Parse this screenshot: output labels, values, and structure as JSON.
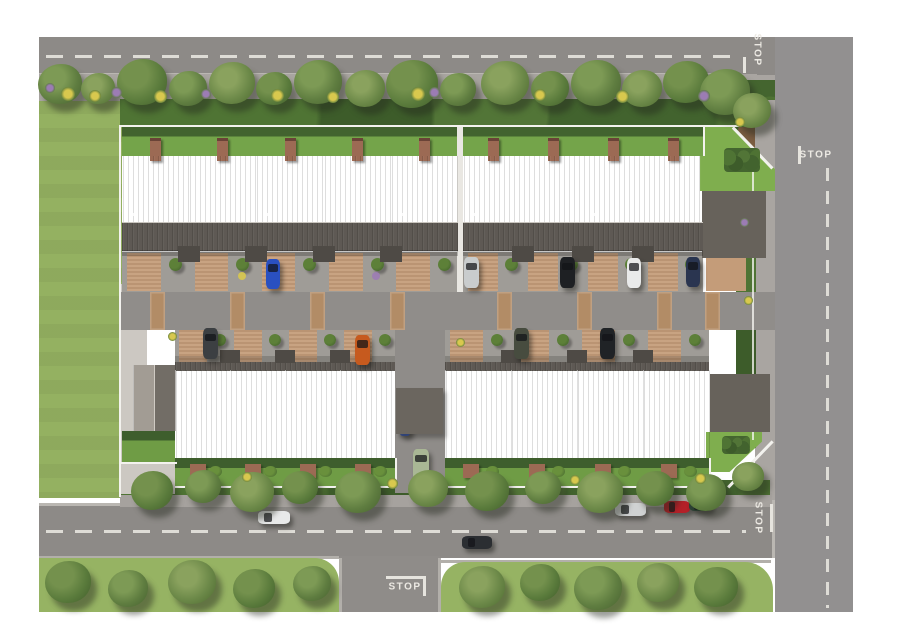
{
  "title": "residential-site-plan-aerial",
  "road_markings": {
    "stop_text": "STOP",
    "instances": [
      "top-road-eastbound",
      "right-road-southbound",
      "bottom-road-eastbound",
      "side-street-northbound"
    ]
  },
  "palette": {
    "asphalt": "#8d8a87",
    "asphalt_light": "#929090",
    "lane": "#908d8a",
    "sidewalk": "#a9a5a1",
    "gravel": "#ccc8c2",
    "curb": "#bab7b2",
    "marking": "#dedcd6",
    "lawn": "#94b161",
    "verge": "#96b363",
    "yard_grass": "#74a44a",
    "corner_lawn": "#7fae4e",
    "bush_dark": "#44652f",
    "tree_green": "#5f7d40",
    "hedge": "#57823a",
    "flower_yellow": "#d8c84e",
    "flower_purple": "#9c7cb4",
    "roof_light": "#9e9890",
    "roof_dark": "#6e6862",
    "roof_porch": "#5e5954",
    "roof_garage": "#67625b",
    "fence": "#f3f2ee",
    "brick": "#9c6a54",
    "paver_band": "#b28c66",
    "driveway": "#c49c79"
  },
  "scene": {
    "blocks": [
      {
        "id": "top-left",
        "row": "top",
        "x": 122,
        "w": 336,
        "units": 5
      },
      {
        "id": "top-right",
        "row": "top",
        "x": 463,
        "w": 240,
        "units": 4
      },
      {
        "id": "bottom-left",
        "row": "bottom",
        "x": 175,
        "w": 220,
        "units": 4
      },
      {
        "id": "bottom-right",
        "row": "bottom",
        "x": 445,
        "w": 264,
        "units": 4
      }
    ],
    "lane_pavers": [
      150,
      230,
      310,
      390,
      497,
      577,
      657,
      705
    ],
    "trees": {
      "north": [
        [
          60,
          86,
          44
        ],
        [
          98,
          90,
          34
        ],
        [
          142,
          84,
          50
        ],
        [
          188,
          90,
          38
        ],
        [
          232,
          85,
          46
        ],
        [
          274,
          90,
          36
        ],
        [
          318,
          84,
          48
        ],
        [
          365,
          90,
          40
        ],
        [
          412,
          86,
          52
        ],
        [
          458,
          91,
          36
        ],
        [
          505,
          85,
          48
        ],
        [
          550,
          90,
          38
        ],
        [
          596,
          85,
          50
        ],
        [
          642,
          90,
          40
        ],
        [
          686,
          84,
          46
        ],
        [
          725,
          94,
          50
        ],
        [
          752,
          112,
          38
        ]
      ],
      "site_south": [
        [
          152,
          492,
          42
        ],
        [
          203,
          488,
          36
        ],
        [
          252,
          494,
          44
        ],
        [
          300,
          489,
          36
        ],
        [
          358,
          494,
          46
        ],
        [
          428,
          490,
          40
        ],
        [
          487,
          493,
          44
        ],
        [
          543,
          489,
          36
        ],
        [
          600,
          494,
          46
        ],
        [
          655,
          490,
          38
        ],
        [
          706,
          494,
          40
        ],
        [
          748,
          478,
          32
        ]
      ],
      "verge_bottom": [
        [
          68,
          584,
          46
        ],
        [
          128,
          590,
          40
        ],
        [
          192,
          584,
          48
        ],
        [
          254,
          590,
          42
        ],
        [
          312,
          585,
          38
        ],
        [
          482,
          589,
          46
        ],
        [
          540,
          584,
          40
        ],
        [
          598,
          590,
          48
        ],
        [
          658,
          584,
          42
        ],
        [
          716,
          589,
          44
        ]
      ]
    },
    "flower_shrubs": [
      [
        50,
        88,
        "p",
        10
      ],
      [
        68,
        94,
        "y",
        14
      ],
      [
        95,
        96,
        "y",
        12
      ],
      [
        116,
        92,
        "p",
        11
      ],
      [
        160,
        96,
        "y",
        13
      ],
      [
        206,
        94,
        "p",
        10
      ],
      [
        277,
        95,
        "y",
        13
      ],
      [
        333,
        97,
        "y",
        12
      ],
      [
        418,
        94,
        "y",
        14
      ],
      [
        434,
        92,
        "p",
        11
      ],
      [
        540,
        95,
        "y",
        12
      ],
      [
        622,
        96,
        "y",
        13
      ],
      [
        704,
        96,
        "p",
        12
      ],
      [
        740,
        122,
        "y",
        10
      ],
      [
        247,
        477,
        "y",
        10
      ],
      [
        392,
        483,
        "y",
        11
      ],
      [
        575,
        480,
        "y",
        10
      ],
      [
        700,
        478,
        "y",
        11
      ],
      [
        748,
        300,
        "y",
        9
      ],
      [
        744,
        222,
        "p",
        9
      ],
      [
        172,
        336,
        "y",
        9
      ],
      [
        460,
        342,
        "y",
        9
      ]
    ],
    "cars": [
      {
        "name": "blue-car",
        "x": 266,
        "y": 259,
        "w": 14,
        "h": 30,
        "dir": "v",
        "color": "#2a50c0"
      },
      {
        "name": "silver-car",
        "x": 464,
        "y": 257,
        "w": 15,
        "h": 31,
        "dir": "v",
        "color": "#c9cccd"
      },
      {
        "name": "black-car",
        "x": 560,
        "y": 257,
        "w": 15,
        "h": 31,
        "dir": "v",
        "color": "#1e2023"
      },
      {
        "name": "white-car",
        "x": 627,
        "y": 258,
        "w": 14,
        "h": 30,
        "dir": "v",
        "color": "#e9eaea"
      },
      {
        "name": "navy-car",
        "x": 686,
        "y": 257,
        "w": 14,
        "h": 30,
        "dir": "v",
        "color": "#2a3550"
      },
      {
        "name": "dark-gray-car",
        "x": 203,
        "y": 328,
        "w": 15,
        "h": 31,
        "dir": "v",
        "color": "#3c3f42"
      },
      {
        "name": "orange-car",
        "x": 355,
        "y": 335,
        "w": 15,
        "h": 30,
        "dir": "v",
        "color": "#c65a1e"
      },
      {
        "name": "olive-car",
        "x": 514,
        "y": 328,
        "w": 15,
        "h": 31,
        "dir": "v",
        "color": "#474c3f"
      },
      {
        "name": "black-car-2",
        "x": 600,
        "y": 328,
        "w": 15,
        "h": 31,
        "dir": "v",
        "color": "#202326"
      },
      {
        "name": "small-blue-car",
        "x": 399,
        "y": 412,
        "w": 12,
        "h": 24,
        "dir": "v",
        "color": "#3b57a2"
      },
      {
        "name": "sage-car",
        "x": 413,
        "y": 449,
        "w": 16,
        "h": 32,
        "dir": "v",
        "color": "#a9b795"
      },
      {
        "name": "parked-white-car",
        "x": 258,
        "y": 511,
        "w": 32,
        "h": 13,
        "dir": "h",
        "color": "#e8e9e9"
      },
      {
        "name": "moving-dark-car",
        "x": 462,
        "y": 536,
        "w": 30,
        "h": 13,
        "dir": "h",
        "color": "#2b2e32"
      },
      {
        "name": "parked-silver-car",
        "x": 615,
        "y": 503,
        "w": 31,
        "h": 13,
        "dir": "h",
        "color": "#d0d2d3"
      },
      {
        "name": "parked-red-car",
        "x": 664,
        "y": 501,
        "w": 26,
        "h": 12,
        "dir": "h",
        "color": "#b42028"
      },
      {
        "name": "parked-green-car",
        "x": 689,
        "y": 499,
        "w": 23,
        "h": 12,
        "dir": "h",
        "color": "#2c4336"
      }
    ]
  }
}
